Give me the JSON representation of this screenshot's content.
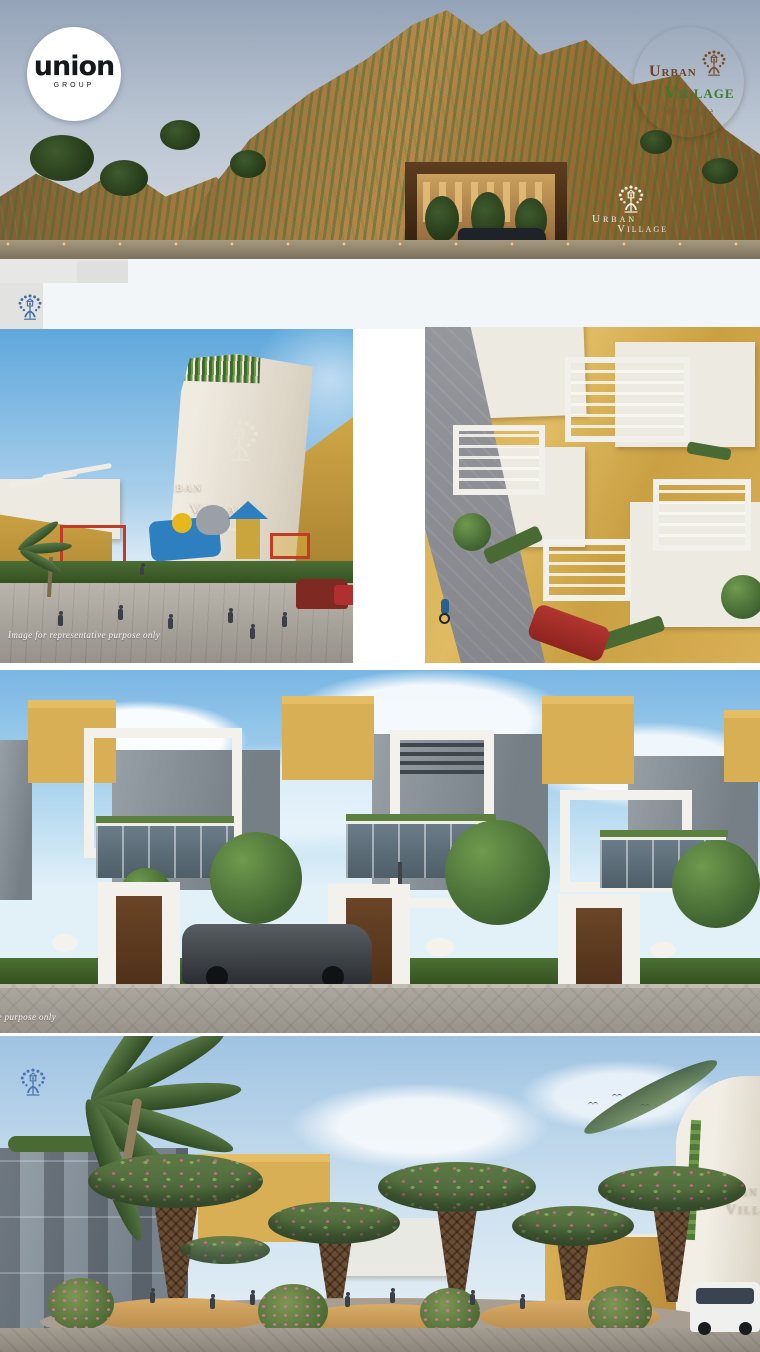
{
  "canvas": {
    "width": 760,
    "height": 1352
  },
  "logos": {
    "union": {
      "text": "union",
      "subtext": "GROUP"
    },
    "urban_village": {
      "word1": "Urban",
      "word2": "Village",
      "tagline": "સૌને ગમે એવું ઘર"
    }
  },
  "watermarks": {
    "disclaimer": "Image for representative purpose only"
  },
  "icons": {
    "tree_logo": "urban-village-tree-icon",
    "union_mark": "union-group-logo"
  },
  "colors": {
    "badge_cream": "#f5ecc6",
    "badge_brown": "#6b4226",
    "badge_green": "#3f7a2e",
    "tree_watermark_blue": "#3f6ba6",
    "sandstone": "#d9af55",
    "hedge_green": "#3f6230",
    "sky_blue": "#7fb9e6",
    "accent_red": "#b03030"
  },
  "scenes": {
    "hero": "entrance-gate-hillscape-dusk",
    "playground": "entrance-tower-with-playground",
    "aerial": "aerial-row-houses",
    "street": "street-elevation-row-houses",
    "plaza": "plaza-with-canopy-trellis-trees"
  }
}
